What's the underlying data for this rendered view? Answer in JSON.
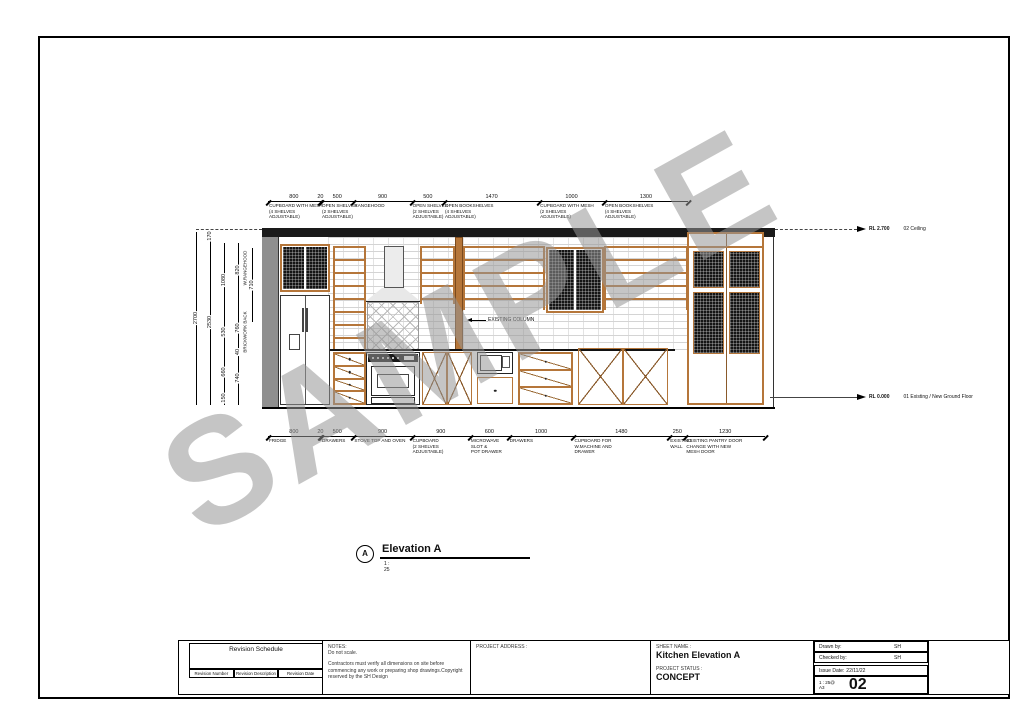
{
  "watermark": "SAMPLE",
  "colors": {
    "wood": "#b5763a",
    "band": "#1a1a1a",
    "wall_gray": "#8f8f8f",
    "mesh": "#141414",
    "watermark_gray": "#969696"
  },
  "scale_mm_per_px": 15.45,
  "top_dims": [
    {
      "value": "800",
      "mm": 800,
      "label": "CUPBOARD WITH MESH\n(4 SHELVES ADJUSTABLE)"
    },
    {
      "value": "20",
      "mm": 20,
      "label": ""
    },
    {
      "value": "500",
      "mm": 500,
      "label": "OPEN SHELVES\n(2 SHELVES ADJUSTABLE)"
    },
    {
      "value": "900",
      "mm": 900,
      "label": "RANGEHOOD"
    },
    {
      "value": "500",
      "mm": 500,
      "label": "OPEN SHELVES\n(2 SHELVES\nADJUSTABLE)"
    },
    {
      "value": "1470",
      "mm": 1470,
      "label": "OPEN BOOKSHELVES\n(4 SHELVES ADJUSTABLE)"
    },
    {
      "value": "1000",
      "mm": 1000,
      "label": "CUPBOARD WITH MESH\n(2 SHELVES ADJUSTABLE)"
    },
    {
      "value": "1300",
      "mm": 1300,
      "label": "OPEN BOOKSHELVES\n(4 SHELVES ADJUSTABLE)"
    }
  ],
  "bottom_dims": [
    {
      "value": "800",
      "mm": 800,
      "label": "FRIDGE"
    },
    {
      "value": "20",
      "mm": 20,
      "label": ""
    },
    {
      "value": "500",
      "mm": 500,
      "label": "DRAWERS"
    },
    {
      "value": "900",
      "mm": 900,
      "label": "STOVE TOP AND OVEN"
    },
    {
      "value": "900",
      "mm": 900,
      "label": "CUPBOARD\n(2 SHELVES ADJUSTABLE)"
    },
    {
      "value": "600",
      "mm": 600,
      "label": "MICROWAVE\nSLOT &\nPOT DRAWER"
    },
    {
      "value": "1000",
      "mm": 1000,
      "label": "DRAWERS"
    },
    {
      "value": "1480",
      "mm": 1480,
      "label": "CUPBOARD FOR\nW.MACHINE AND DRAWER"
    },
    {
      "value": "250",
      "mm": 250,
      "label": "EXISTING\nWALL"
    },
    {
      "value": "1230",
      "mm": 1230,
      "label": "EXISTING PANTRY DOOR\nCHANGE WITH NEW\nMESH DOOR"
    }
  ],
  "left_dims": {
    "overall": "2700",
    "bulkhead": "170",
    "wall": "2530",
    "chain_a": {
      "a1": "1080",
      "a2": "530",
      "a3": "660",
      "a4": "150"
    },
    "chain_b": {
      "b1": "820",
      "b2": "760",
      "b3": "40",
      "b4": "740"
    },
    "rangehood": "710",
    "label_rangehood": "W.RANGEHOOD",
    "label_brick": "BRICKWORK BACK"
  },
  "levels": {
    "ceiling": {
      "rl": "RL 2.700",
      "name": "02 Ceiling"
    },
    "ground": {
      "rl": "RL 0.000",
      "name": "01 Existing / New Ground Floor"
    }
  },
  "callouts": {
    "existing_column": "EXISTING COLUMN"
  },
  "view_title": {
    "bubble": "A",
    "name": "Elevation A",
    "scale": "1 : 25"
  },
  "title_block": {
    "revision": {
      "title": "Revision Schedule",
      "columns": [
        "Revision Number",
        "Revision Description",
        "Revision Date"
      ]
    },
    "notes": {
      "heading": "NOTES:",
      "line1": "Do not scale.",
      "body": "Contractors must verify all dimensions on site before commencing any work or preparing shop drawings.Copyright reserved by the SH Design"
    },
    "project_address_label": "PROJECT ADDRESS :",
    "sheet_name_label": "SHEET NAME :",
    "sheet_name": "Kitchen Elevation A",
    "project_status_label": "PROJECT STATUS :",
    "project_status": "CONCEPT",
    "drawn_by_label": "Drawn by:",
    "drawn_by": "SH",
    "checked_by_label": "Checked by:",
    "checked_by": "SH",
    "issue_date_label": "Issue Date:",
    "issue_date": "22/11/22",
    "scale_at": "1 : 25@",
    "paper": "A3",
    "sheet_number": "02"
  }
}
